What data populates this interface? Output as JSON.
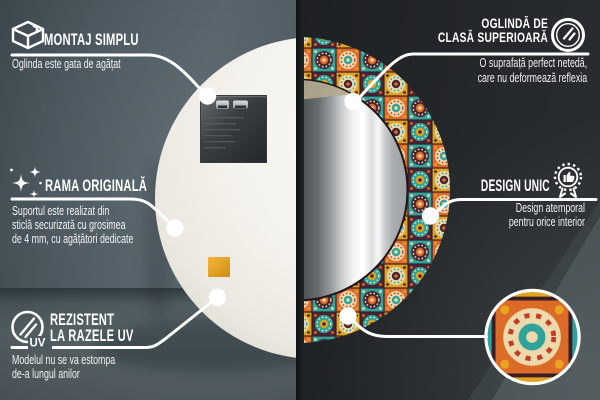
{
  "palette": {
    "accent_white": "#ffffff",
    "left_wall": "#525e65",
    "right_wall": "#242729",
    "tile_teal": "#2fa39b",
    "tile_orange": "#dd6b28",
    "tile_mustard": "#e2a41f",
    "tile_maroon": "#472531",
    "tile_cream": "#ecd9ac",
    "pad_orange": "#e8a41c"
  },
  "callouts": {
    "montaj": {
      "icon": "package-box-icon",
      "title": "MONTAJ SIMPLU",
      "subtitle_lines": [
        "Oglinda este gata de agățat"
      ]
    },
    "rama": {
      "icon": "sparkles-icon",
      "title": "RAMA ORIGINALĂ",
      "subtitle_lines": [
        "Suportul este realizat din",
        "sticlă securizată cu grosimea",
        "de 4 mm, cu agățători dedicate"
      ]
    },
    "uv": {
      "icon": "uv-resistant-icon",
      "icon_label": "UV",
      "title_lines": [
        "REZISTENT",
        "LA RAZELE UV"
      ],
      "subtitle_lines": [
        "Modelul nu se va estompa",
        "de-a lungul anilor"
      ]
    },
    "premium": {
      "icon": "premium-mirror-icon",
      "title_lines": [
        "OGLINDĂ DE",
        "CLASĂ SUPERIOARĂ"
      ],
      "subtitle_lines": [
        "O suprafață perfect netedă,",
        "care nu deformează reflexia"
      ]
    },
    "design": {
      "icon": "award-badge-icon",
      "title": "DESIGN UNIC",
      "subtitle_lines": [
        "Design atemporal",
        "pentru orice interior"
      ]
    }
  }
}
